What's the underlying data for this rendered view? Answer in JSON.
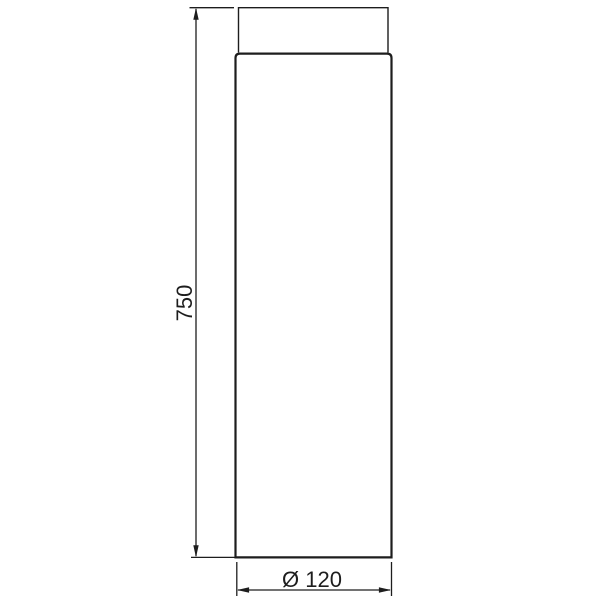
{
  "drawing": {
    "labels": {
      "height": "750",
      "diameter": "Ø 120"
    },
    "values": {
      "height_mm": 750,
      "diameter_mm": 120
    },
    "colors": {
      "line": "#1d1d1d",
      "background": "#ffffff"
    }
  }
}
